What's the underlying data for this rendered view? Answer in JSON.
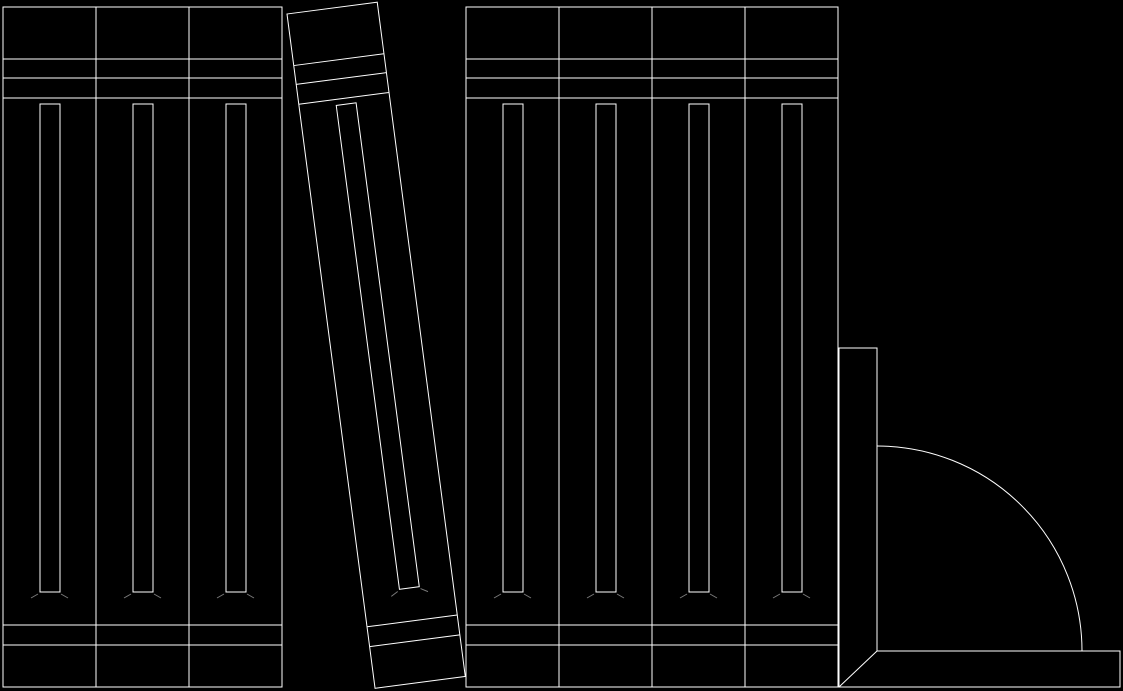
{
  "app": {
    "name": "cad-drawing-canvas",
    "background": "#000000",
    "stroke": "#ffffff",
    "tick_stroke": "#7a7a7a",
    "content": "line drawing of a row of books with one tilted book and a bookend"
  },
  "drawing": {
    "width": 1123,
    "height": 691,
    "book_template": {
      "width": 93,
      "height": 680,
      "h_lines": [
        52,
        71,
        91,
        618,
        638
      ],
      "label_rect": {
        "x": 37,
        "y": 97,
        "width": 20,
        "height": 488
      },
      "label_ticks": [
        {
          "x1": 35,
          "y1": 587,
          "x2": 28,
          "y2": 591
        },
        {
          "x1": 58,
          "y1": 587,
          "x2": 65,
          "y2": 591
        }
      ]
    },
    "books": [
      {
        "id": "book-left-1",
        "x": 3,
        "y": 7
      },
      {
        "id": "book-left-2",
        "x": 96,
        "y": 7
      },
      {
        "id": "book-left-3",
        "x": 189,
        "y": 7
      },
      {
        "id": "book-tilted",
        "x": 287,
        "y": 14,
        "rotate": -7.44,
        "width": 91
      },
      {
        "id": "book-right-1",
        "x": 466,
        "y": 7
      },
      {
        "id": "book-right-2",
        "x": 559,
        "y": 7
      },
      {
        "id": "book-right-3",
        "x": 652,
        "y": 7
      },
      {
        "id": "book-right-4",
        "x": 745,
        "y": 7
      }
    ],
    "bookend": {
      "id": "bookend",
      "outline": [
        [
          839,
          348
        ],
        [
          877,
          348
        ],
        [
          877,
          651
        ],
        [
          1120,
          651
        ],
        [
          1120,
          687
        ],
        [
          839,
          687
        ]
      ],
      "diagonal": {
        "x1": 839,
        "y1": 687,
        "x2": 877,
        "y2": 651
      },
      "arc": {
        "r": 205,
        "start": [
          877,
          446
        ],
        "end": [
          1082,
          651
        ]
      }
    },
    "counts": {
      "straight_books": 7,
      "tilted_books": 1,
      "bookends": 1
    }
  }
}
